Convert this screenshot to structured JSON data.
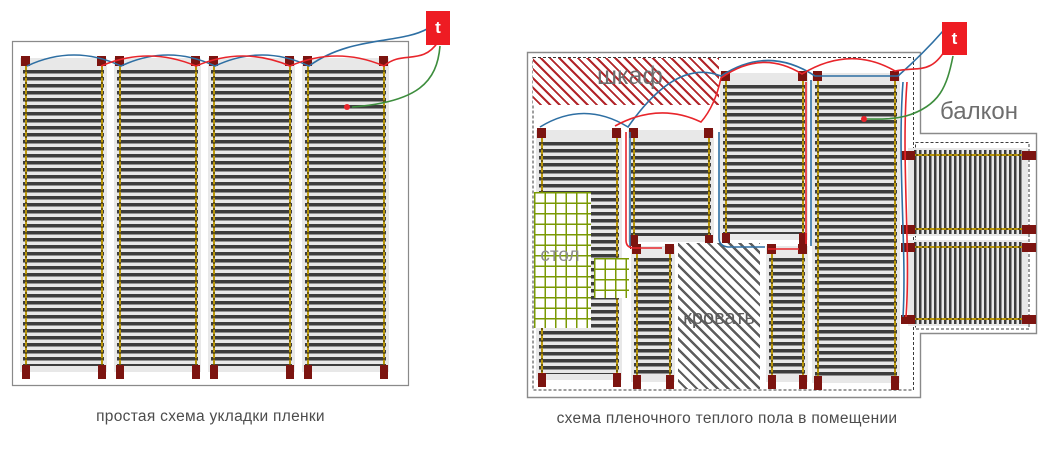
{
  "canvas": {
    "w": 1052,
    "h": 450
  },
  "colors": {
    "strip_bg": "#e8e8e8",
    "stripe_dark": "#3d3d3d",
    "bus_gold": "#b8960b",
    "bus_gold_dark": "#6e5906",
    "terminal": "#7c1410",
    "thermostat_red": "#ee1c23",
    "wire_blue": "#2e6fa3",
    "wire_red": "#e8252b",
    "wire_green": "#3d8d3d",
    "hatch_red": "#b2252a",
    "hatch_gray": "#5d5d5d",
    "grid_green": "#7a9a04",
    "wall_gray": "#8a8a8a",
    "boundary_dark": "#3c3c3c",
    "label_gray": "#6e6e6e",
    "caption_gray": "#4c4c4c"
  },
  "left_diagram": {
    "caption": "простая схема укладки пленки",
    "thermostat_label": "t",
    "thermostat": {
      "x": 426,
      "y": 11,
      "w": 24,
      "h": 34
    },
    "border_path": "M12.5,41.5 H408.5 V385.5 H12.5 Z",
    "strips": [
      {
        "x": 20,
        "y": 58,
        "w": 87,
        "h": 314,
        "dir": "v"
      },
      {
        "x": 114,
        "y": 58,
        "w": 87,
        "h": 314,
        "dir": "v"
      },
      {
        "x": 208,
        "y": 58,
        "w": 87,
        "h": 314,
        "dir": "v"
      },
      {
        "x": 302,
        "y": 58,
        "w": 87,
        "h": 314,
        "dir": "v"
      }
    ],
    "wires": {
      "blue": "M27,66 Q74,44 121,66 Q168,44 215,66 Q262,44 309,66 C350,36 400,44 427,29",
      "red": "M101,66 Q148,46 196,66 Q243,46 290,66 Q337,46 384,66 C402,50 422,66 438,42",
      "green": "M440,46 C437,82 418,102 352,107"
    },
    "sensor": {
      "x": 347,
      "y": 107
    }
  },
  "right_diagram": {
    "caption": "схема пленочного теплого пола в помещении",
    "thermostat_label": "t",
    "thermostat": {
      "x": 942,
      "y": 22,
      "w": 25,
      "h": 33
    },
    "wall_path": "M527.5,52.5 H920.5 V133.5 H1036.5 V333.5 H920.5 V397.5 H527.5 Z",
    "boundary_paths": [
      "M533,57.5 H913.5 V390 H533 Z",
      "M915.5,142.5 H1029 V329 H915.5 Z"
    ],
    "labels": [
      {
        "name": "wardrobe-label",
        "text": "шкаф",
        "x": 560,
        "y": 64,
        "w": 140,
        "size": 25,
        "color": "#6e6e6e"
      },
      {
        "name": "balcony-label",
        "text": "балкон",
        "x": 933,
        "y": 100,
        "w": 92,
        "size": 24,
        "color": "#6e6e6e"
      },
      {
        "name": "table-label",
        "text": "стол",
        "x": 534,
        "y": 246,
        "w": 52,
        "size": 19,
        "color": "#8d8d8d"
      },
      {
        "name": "bed-label",
        "text": "кровать",
        "x": 678,
        "y": 308,
        "w": 82,
        "size": 20,
        "color": "#5d5d5d"
      }
    ],
    "areas": [
      {
        "name": "wardrobe-area",
        "cls": "hatch-red",
        "x": 533,
        "y": 58,
        "w": 186,
        "h": 47
      },
      {
        "name": "table-area",
        "cls": "grid-green",
        "x": 534,
        "y": 192,
        "w": 57,
        "h": 136
      },
      {
        "name": "table-area-extension",
        "cls": "grid-green",
        "x": 594,
        "y": 258,
        "w": 35,
        "h": 40
      },
      {
        "name": "bed-area",
        "cls": "hatch-gray",
        "x": 678,
        "y": 243,
        "w": 82,
        "h": 146
      }
    ],
    "strips": [
      {
        "x": 536,
        "y": 130,
        "w": 86,
        "h": 250,
        "dir": "v"
      },
      {
        "x": 628,
        "y": 130,
        "w": 86,
        "h": 112,
        "dir": "v"
      },
      {
        "x": 631,
        "y": 246,
        "w": 44,
        "h": 136,
        "dir": "v"
      },
      {
        "x": 720,
        "y": 73,
        "w": 88,
        "h": 167,
        "dir": "v"
      },
      {
        "x": 766,
        "y": 246,
        "w": 42,
        "h": 136,
        "dir": "v"
      },
      {
        "x": 812,
        "y": 73,
        "w": 88,
        "h": 310,
        "dir": "v"
      },
      {
        "x": 908,
        "y": 148,
        "w": 120,
        "h": 88,
        "dir": "h"
      },
      {
        "x": 908,
        "y": 240,
        "w": 120,
        "h": 86,
        "dir": "h"
      }
    ],
    "wires": {
      "blue": "M540,127 Q584,100 628,127 Q676,58 721,76 Q768,45 815,76 L898,76 C916,60 929,47 943,31 M630,132 V246 M811,80 V246 M719,132 V238 Q719,246 728,247 L765,247 M903,82 C897,160 907,250 903,317",
      "red": "M615,126 Q659,102 701,122 Q715,106 721,78 Q762,49 802,74 Q850,45 895,71 C918,66 932,76 948,45 M626,132 V240 Q626,248 634,248 L662,248 M806,82 V244 M768,249 H799 M907,82 C901,160 911,250 906,317",
      "green": "M953,56 C947,86 940,106 906,116 C890,120 876,119 867,119"
    },
    "sensor": {
      "x": 864,
      "y": 119
    }
  }
}
